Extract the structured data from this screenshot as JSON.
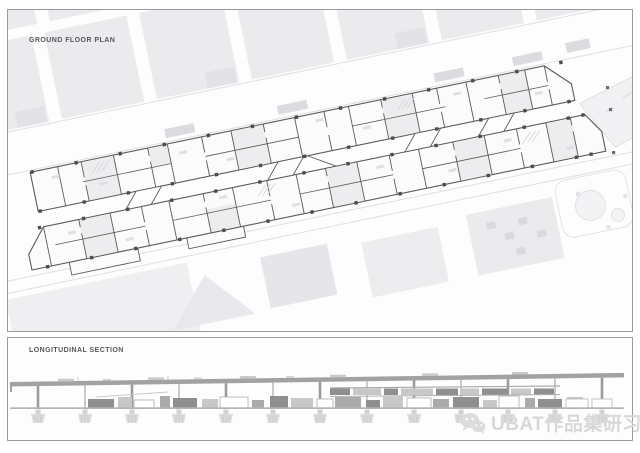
{
  "plan_panel": {
    "label": "GROUND FLOOR PLAN"
  },
  "section_panel": {
    "label": "LONGITUDINAL SECTION"
  },
  "watermark": {
    "brand": "UBAT作品集研习社",
    "icon": "wechat-icon"
  },
  "colors": {
    "panel_border": "#98989e",
    "label": "#57575c",
    "context": "#ebebee",
    "context_dark": "#e2e2e6",
    "street_line": "#dedee2",
    "street_building": "#dcdce0",
    "wall": "#5a5a5a",
    "column": "#4d4d4d",
    "room_fill": "#ededef",
    "building_fill": "#fbfbfc",
    "tick": "#e0e0e4",
    "hatch": "#d8d8dc",
    "plaza": "#f1f1f4",
    "plaza_stroke": "#e2e2e6",
    "slab": "#a2a2a2",
    "pier": "#9b9b9b",
    "pier_thin": "#b0b0b0",
    "ground": "#b4b4b4",
    "footing": "#dcdcdc",
    "footing_hatch": "#c2c2c2",
    "box_dark": "#8f8f8f",
    "box_mid": "#ababab",
    "box_light": "#c8c8c8",
    "roof_bump": "#cacaca",
    "watermark": "#d8d8d8"
  }
}
